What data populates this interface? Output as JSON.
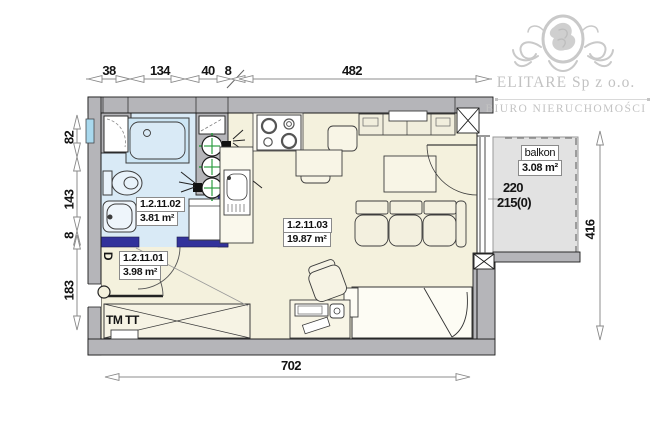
{
  "branding": {
    "company": "ELITARE Sp z o.o.",
    "tagline": "BIURO NIERUCHOMOŚCI",
    "logo_color": "#c9c9c9"
  },
  "dims": {
    "top": [
      "38",
      "134",
      "40",
      "8",
      "482"
    ],
    "left": [
      "82",
      "143",
      "8",
      "183"
    ],
    "right": [
      "416"
    ],
    "bottom": [
      "702"
    ]
  },
  "rooms": {
    "bathroom": {
      "id": "1.2.11.02",
      "area": "3.81 m²"
    },
    "main": {
      "id": "1.2.11.03",
      "area": "19.87 m²"
    },
    "hall": {
      "id": "1.2.11.01",
      "area": "3.98 m²"
    }
  },
  "balcony": {
    "label": "balkon",
    "area": "3.08 m²",
    "window_width": "220",
    "window_sill": "215(0)"
  },
  "annotations": {
    "radiator": "TM TT",
    "door_letter": "D"
  },
  "colors": {
    "wall_gray": "#b5b5b9",
    "main_floor": "#f4f1dd",
    "bathroom_floor": "#d9eaf6",
    "balcony_floor": "#e2e2e2",
    "partition_navy": "#32329b",
    "meter_green": "#2f9e44",
    "window_cyan": "#a9d9ee",
    "logo_gray": "#c9c9c9"
  }
}
